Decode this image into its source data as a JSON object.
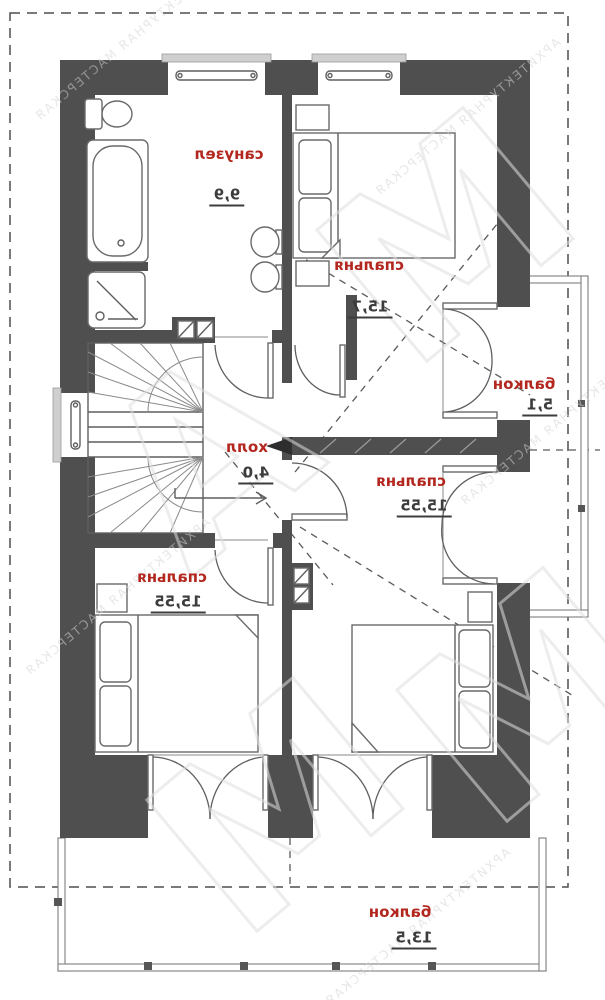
{
  "plan": {
    "floor_type": "floor-plan",
    "units_note": "",
    "rooms": [
      {
        "id": "bathroom",
        "name": "санузел",
        "area": "9,9"
      },
      {
        "id": "bedroom-top",
        "name": "спальня",
        "area": "15,7"
      },
      {
        "id": "hall",
        "name": "холл",
        "area": "4,0"
      },
      {
        "id": "balcony-right",
        "name": "балкон",
        "area": "5,1"
      },
      {
        "id": "bedroom-right",
        "name": "спальня",
        "area": "15,55"
      },
      {
        "id": "bedroom-left",
        "name": "спальня",
        "area": "15,55"
      },
      {
        "id": "balcony-bottom",
        "name": "балкон",
        "area": "13,5"
      }
    ]
  },
  "watermark": {
    "big1": "М",
    "big2": "А",
    "big3": "М",
    "big4": "М",
    "small": "АРХИТЕКТУРНАЯ МАСТЕРСКАЯ"
  },
  "colors": {
    "wall": "#4f4f4f",
    "room_name": "#b3271f",
    "room_area": "#3c3c3c",
    "line": "#5f5f5f",
    "watermark": "#dedede"
  }
}
